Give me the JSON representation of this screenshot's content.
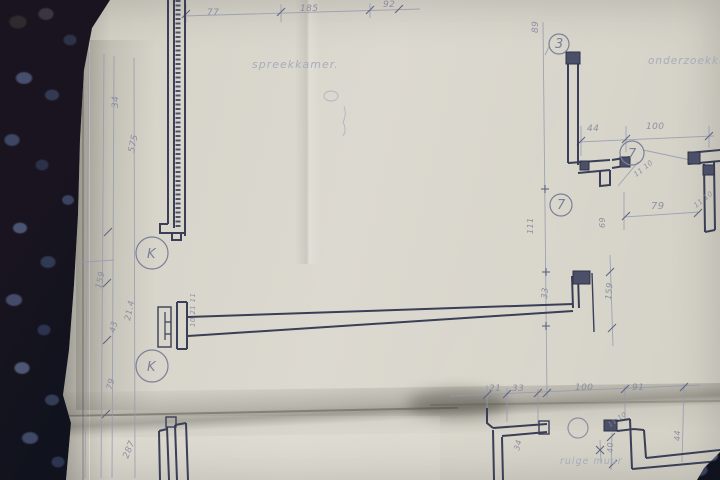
{
  "colors": {
    "carpet_dark": "#10131d",
    "carpet_loop_blue": "#4c5570",
    "paper": "#d8d5cb",
    "ink_dark": "#3a3e56",
    "ink_light": "#959ab0",
    "pencil_text": "#84879c"
  },
  "plan": {
    "rooms": [
      "spreekkamer.",
      "onderzoekkamer"
    ],
    "note": "ruige muur",
    "bubbles": [
      "K",
      "K",
      "3",
      "7",
      "7"
    ],
    "dims": [
      "77",
      "185",
      "92",
      "89",
      "34",
      "575",
      "44",
      "100",
      "79",
      "11 10",
      "11 10",
      "111",
      "69",
      "33",
      "159",
      "159",
      "43",
      "21.4",
      "79",
      "287",
      "10 21 11",
      "21",
      "33",
      "100",
      "91",
      "34",
      "40",
      "44",
      "11 10"
    ]
  }
}
